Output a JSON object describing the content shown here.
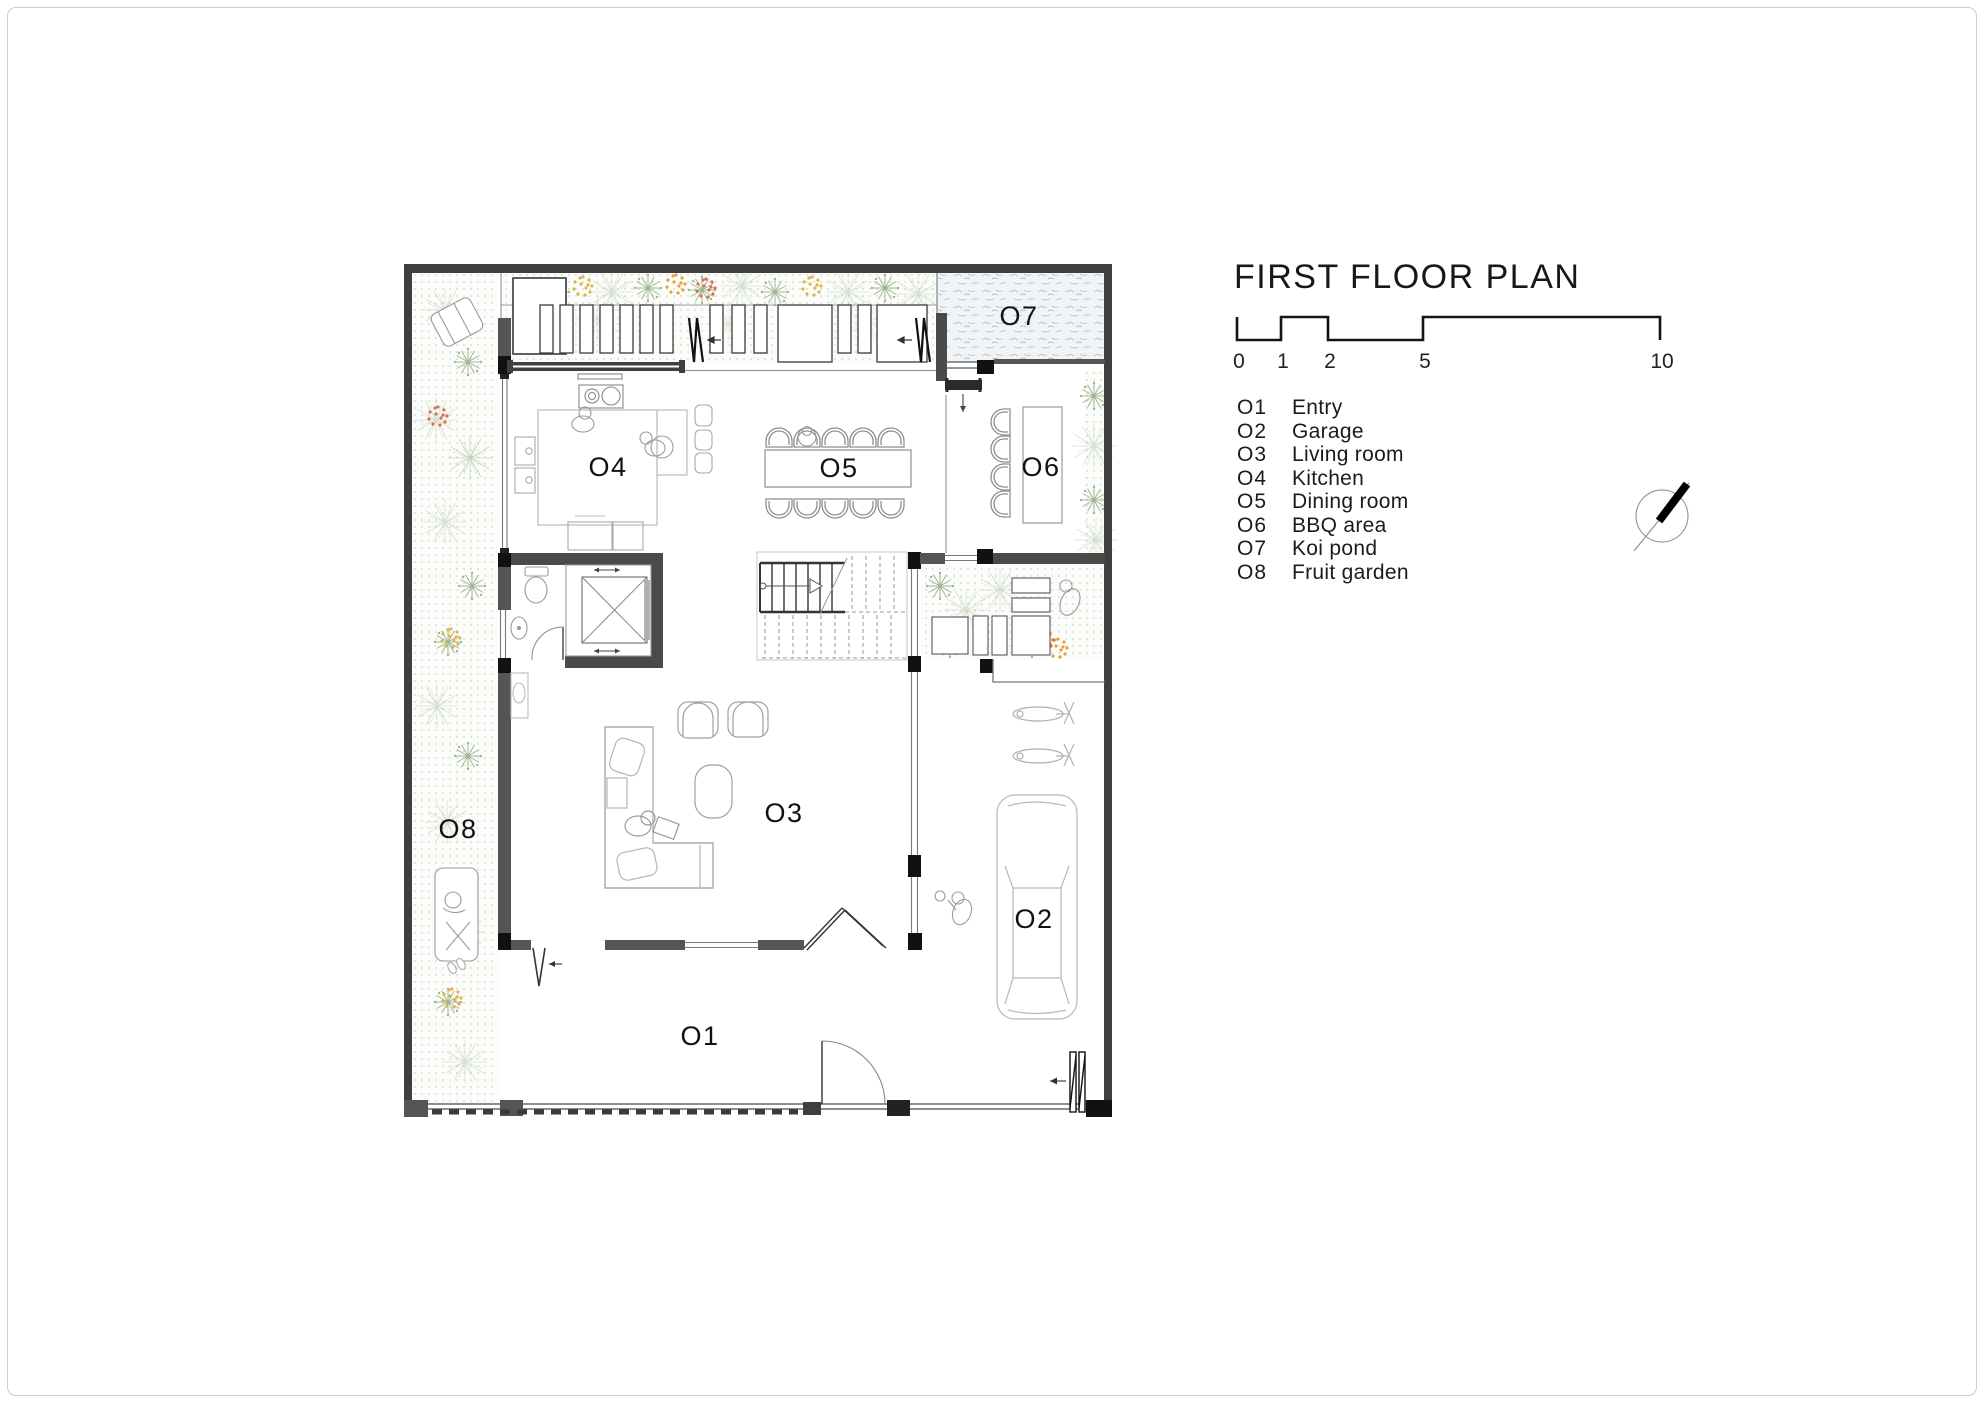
{
  "title": "FIRST FLOOR PLAN",
  "scale_bar": {
    "ticks": [
      "0",
      "1",
      "2",
      "5",
      "10"
    ]
  },
  "legend": {
    "items": [
      {
        "code": "O1",
        "label": "Entry"
      },
      {
        "code": "O2",
        "label": "Garage"
      },
      {
        "code": "O3",
        "label": "Living room"
      },
      {
        "code": "O4",
        "label": "Kitchen"
      },
      {
        "code": "O5",
        "label": "Dining room"
      },
      {
        "code": "O6",
        "label": "BBQ area"
      },
      {
        "code": "O7",
        "label": "Koi pond"
      },
      {
        "code": "O8",
        "label": "Fruit garden"
      }
    ]
  },
  "icons": {
    "north_arrow": "diagonal-needle-in-circle"
  },
  "colors": {
    "wall_dark": "#3f3f3f",
    "wall_black": "#111111",
    "line_light": "#9a9a9a",
    "garden_dot": "#c6d6bf",
    "plant_green": "#9db792",
    "plant_sage": "#b7c9ae",
    "plant_orange": "#e0b34c",
    "plant_red": "#d96f4e",
    "pond_texture": "#aebfca"
  }
}
